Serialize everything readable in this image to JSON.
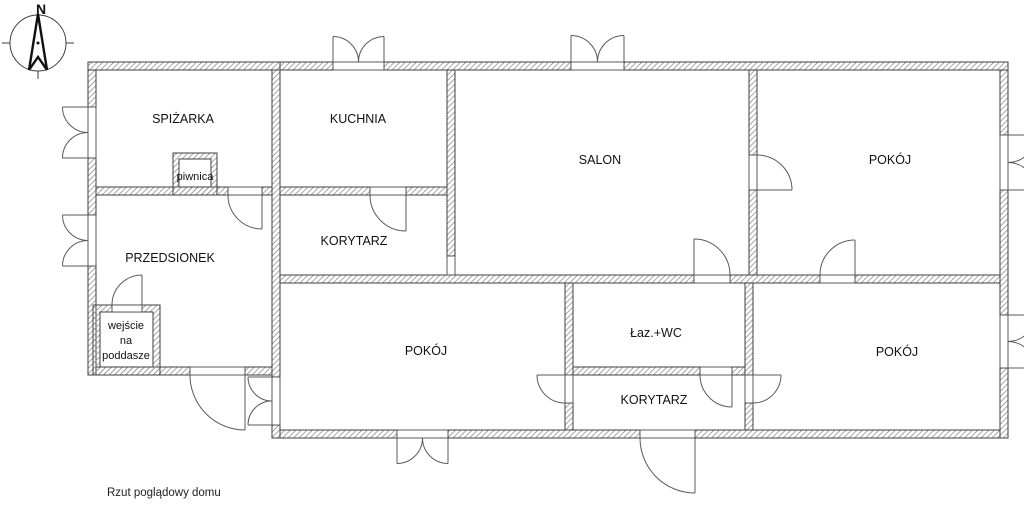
{
  "caption": "Rzut poglądowy domu",
  "compass": {
    "north_label": "N"
  },
  "colors": {
    "background": "#ffffff",
    "wall_line": "#3f3f3f",
    "hatch_line": "#999999",
    "door_line": "#5a5a5a",
    "text": "#111111"
  },
  "rooms": [
    {
      "id": "spizarka",
      "label": "SPIŻARKA"
    },
    {
      "id": "kuchnia",
      "label": "KUCHNIA"
    },
    {
      "id": "salon",
      "label": "SALON"
    },
    {
      "id": "pokoj-polnocno-wschodni",
      "label": "POKÓJ"
    },
    {
      "id": "przedsionek",
      "label": "PRZEDSIONEK"
    },
    {
      "id": "korytarz-gorny",
      "label": "KORYTARZ"
    },
    {
      "id": "pokoj-srodkowy",
      "label": "POKÓJ"
    },
    {
      "id": "lazienka-wc",
      "label": "Łaz.+WC"
    },
    {
      "id": "korytarz-dolny",
      "label": "KORYTARZ"
    },
    {
      "id": "pokoj-poludniowo-wschodni",
      "label": "POKÓJ"
    }
  ],
  "annotations": [
    {
      "id": "piwnica",
      "label": "piwnica"
    },
    {
      "id": "wejscie-na-poddasze",
      "lines": [
        "wejście",
        "na",
        "poddasze"
      ]
    }
  ]
}
